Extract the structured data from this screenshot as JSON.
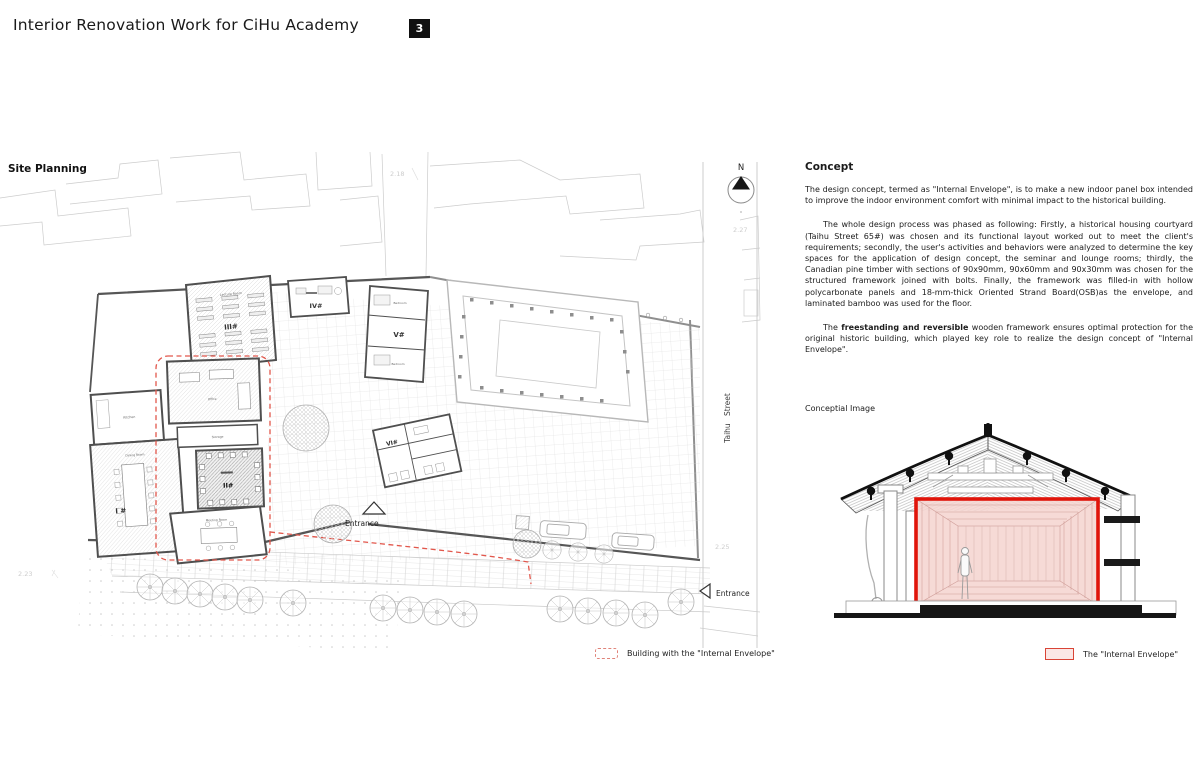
{
  "header": {
    "title": "Interior Renovation Work for CiHu Academy",
    "page_number": "3"
  },
  "plan": {
    "heading": "Site Planning",
    "north_label": "N",
    "street_label": "Taihu Street",
    "entrance_label": "Entrance",
    "entrance_label_2": "Entrance",
    "elevation_top": "2.18",
    "elevation_right_upper": "2.27",
    "elevation_right_lower": "2.25",
    "elevation_left_lower": "2.23",
    "rooms": {
      "lecture": "Lecture Room",
      "r3": "III#",
      "r4": "IV#",
      "r5": "V#",
      "r6": "VI#",
      "r2": "II#",
      "r1": "I #",
      "kitchen": "Kitchen",
      "dining": "Dining Room",
      "storage": "Storage",
      "office": "Office",
      "meeting": "Meeting Room",
      "bedroom_upper": "Bedroom",
      "bedroom_lower": "Bedroom"
    },
    "legend_label": "Building with the \"Internal Envelope\""
  },
  "concept": {
    "heading": "Concept",
    "paragraph_1": "The design concept, termed as \"Internal Envelope\", is to make a new indoor panel box intended to improve the indoor environment comfort with minimal impact to the historical building.",
    "paragraph_2": "The whole design process was phased as following: Firstly, a historical housing courtyard (Taihu Street 65#) was chosen and its functional layout worked out to meet the client's requirements; secondly, the user's activities and behaviors were analyzed to determine the key spaces for the application of design concept, the seminar and lounge rooms; thirdly, the Canadian pine timber with sections of 90x90mm, 90x60mm and 90x30mm was chosen for the structured framework joined with bolts. Finally, the framework was filled-in with hollow polycarbonate panels and 18-mm-thick Oriented Strand Board(OSB)as the envelope, and laminated bamboo was used for the floor.",
    "paragraph_3_pre": "The ",
    "paragraph_3_bold": "freestanding and reversible",
    "paragraph_3_post": " wooden framework ensures optimal protection for the original historic building, which played key role to realize the design concept of \"Internal Envelope\".",
    "image_label": "Conceptial Image",
    "legend_label": "The \"Internal Envelope\""
  },
  "colors": {
    "envelope_red": "#e0140a",
    "dashed_red": "#e2574c",
    "pink_fill": "#f5d3cf",
    "wall_gray": "#4f4f4f"
  }
}
